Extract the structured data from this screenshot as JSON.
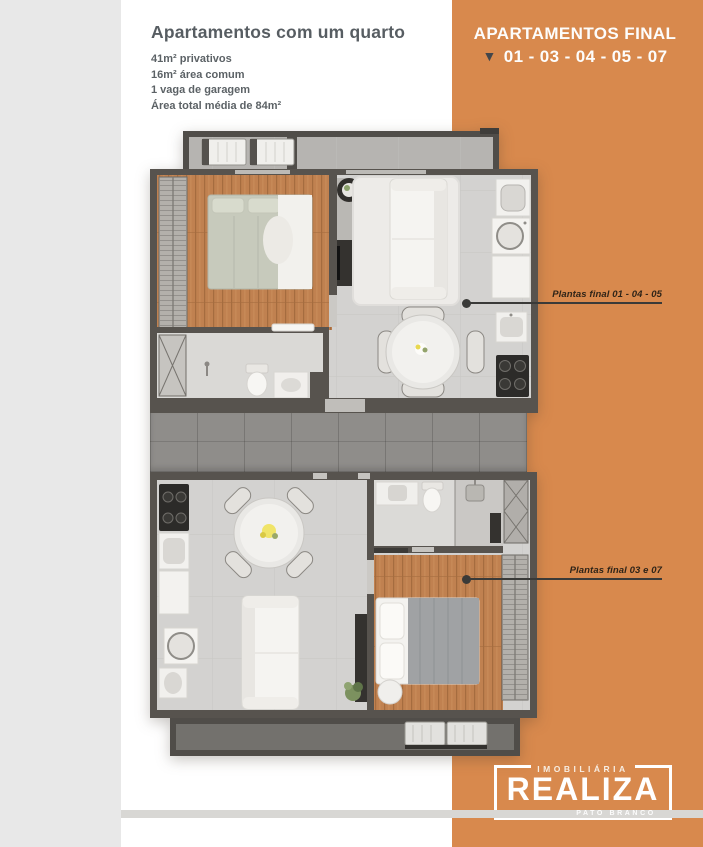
{
  "header": {
    "title": "Apartamentos com um quarto",
    "details": [
      "41m² privativos",
      "16m² área comum",
      "1 vaga de garagem",
      "Área total média de 84m²"
    ]
  },
  "banner": {
    "line1": "APARTAMENTOS FINAL",
    "triangle_icon": "▼",
    "line2": "01 - 03 - 04 - 05 - 07"
  },
  "annotations": {
    "plan_top": {
      "label": "Plantas final 01 - 04 - 05"
    },
    "plan_bottom": {
      "label": "Plantas final 03 e 07"
    }
  },
  "logo": {
    "tagline_top": "IMOBILIÁRIA",
    "name": "REALIZA",
    "tagline_bottom": "PATO BRANCO"
  },
  "colors": {
    "accent_orange": "#d8894d",
    "page_background": "#e8e8e8",
    "card_background": "#ffffff",
    "plan_wall": "#57534e",
    "wood_floor": "#c08150",
    "tile_floor": "#d3d2d0"
  }
}
